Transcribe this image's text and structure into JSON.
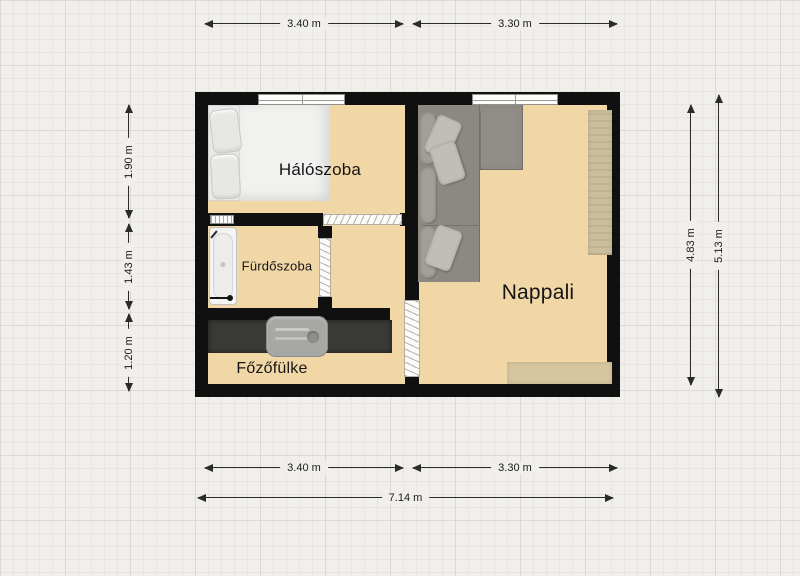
{
  "rooms": {
    "bedroom": "Hálószoba",
    "bathroom": "Fürdőszoba",
    "kitchenette": "Főzőfülke",
    "living_room": "Nappali"
  },
  "dimensions": {
    "top_left": "3.40 m",
    "top_right": "3.30 m",
    "left_upper": "1.90 m",
    "left_middle": "1.43 m",
    "left_lower": "1.20 m",
    "right_inner": "4.83 m",
    "right_outer": "5.13 m",
    "bottom_left": "3.40 m",
    "bottom_right": "3.30 m",
    "bottom_total": "7.14 m"
  },
  "colors": {
    "wall": "#101010",
    "floor": "#f2d7a6",
    "background": "#f1efec",
    "counter": "#3a3a38",
    "sofa": "#8c8983",
    "cabinet": "#ccbe9c",
    "rug": "#d6c59e",
    "dimension_line": "#2b2b2b"
  }
}
